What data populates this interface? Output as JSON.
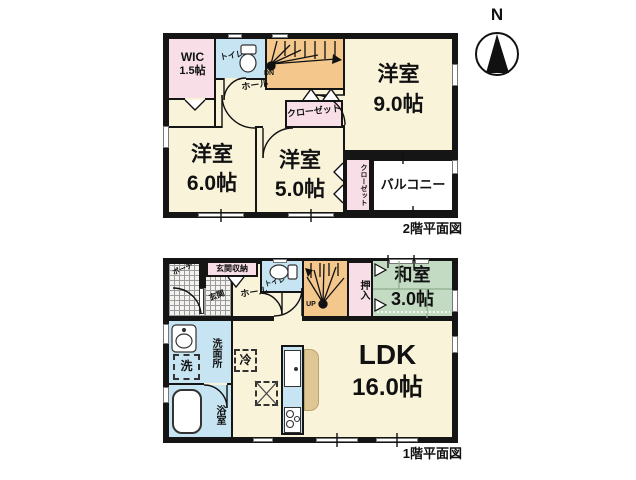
{
  "compass": {
    "north_label": "N"
  },
  "floor2": {
    "caption": "2階平面図",
    "wic": {
      "name": "WIC",
      "size": "1.5帖"
    },
    "toilet": "トイレ",
    "hall": "ホール",
    "stairs": "DN",
    "closet_top": "クローゼット",
    "closet_side": "クローゼット",
    "bedroom_right": {
      "name": "洋室",
      "size": "9.0帖"
    },
    "bedroom_left": {
      "name": "洋室",
      "size": "6.0帖"
    },
    "bedroom_mid": {
      "name": "洋室",
      "size": "5.0帖"
    },
    "balcony": "バルコニー"
  },
  "floor1": {
    "caption": "1階平面図",
    "porch": "ポーチ",
    "entrance": "玄関",
    "entrance_storage": "玄関収納",
    "hall": "ホール",
    "toilet": "トイレ",
    "stairs": "UP",
    "oshiire": "押入",
    "tatami_room": {
      "name": "和室",
      "size": "3.0帖"
    },
    "washroom": "洗面所",
    "washer": "洗",
    "bathroom": "浴室",
    "fridge": "冷",
    "ldk": {
      "name": "LDK",
      "size": "16.0帖"
    }
  },
  "colors": {
    "wall": "#151515",
    "room_cream": "#f8f3d9",
    "room_pink": "#f7dee7",
    "room_blue": "#c6e4f2",
    "stairs_orange": "#f4c88d",
    "tatami_green": "#c3dbc2",
    "counter_tan": "#dfc795"
  }
}
